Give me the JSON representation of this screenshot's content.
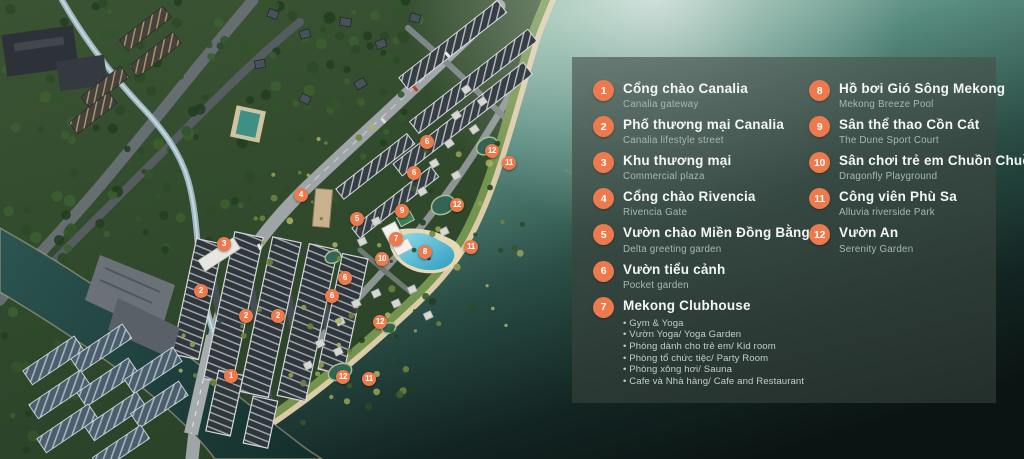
{
  "legend": {
    "column1": [
      {
        "num": "1",
        "title": "Cổng chào Canalia",
        "subtitle": "Canalia gateway"
      },
      {
        "num": "2",
        "title": "Phố thương mại Canalia",
        "subtitle": "Canalia lifestyle street"
      },
      {
        "num": "3",
        "title": "Khu thương mại",
        "subtitle": "Commercial plaza"
      },
      {
        "num": "4",
        "title": "Cổng chào Rivencia",
        "subtitle": "Rivencia Gate"
      },
      {
        "num": "5",
        "title": "Vườn chào Miền Đồng Bằng",
        "subtitle": "Delta greeting garden"
      },
      {
        "num": "6",
        "title": "Vườn tiểu cảnh",
        "subtitle": "Pocket garden"
      },
      {
        "num": "7",
        "title": "Mekong Clubhouse",
        "subtitle": "",
        "bullets": [
          "Gym & Yoga",
          "Vườn Yoga/ Yoga Garden",
          "Phòng dành cho trẻ em/ Kid room",
          "Phòng tổ chức tiệc/ Party Room",
          "Phòng xông hơi/ Sauna",
          "Cafe và Nhà hàng/ Cafe and Restaurant"
        ]
      }
    ],
    "column2": [
      {
        "num": "8",
        "title": "Hồ bơi Gió Sông Mekong",
        "subtitle": "Mekong Breeze Pool"
      },
      {
        "num": "9",
        "title": "Sân thể thao Cồn Cát",
        "subtitle": "The Dune Sport Court"
      },
      {
        "num": "10",
        "title": "Sân chơi trẻ em Chuồn Chuồn",
        "subtitle": "Dragonfly Playground"
      },
      {
        "num": "11",
        "title": "Công viên Phù Sa",
        "subtitle": "Alluvia riverside Park"
      },
      {
        "num": "12",
        "title": "Vườn An",
        "subtitle": "Serenity Garden"
      }
    ]
  },
  "map": {
    "markers": [
      {
        "num": "1",
        "x": 231,
        "y": 376
      },
      {
        "num": "2",
        "x": 201,
        "y": 291
      },
      {
        "num": "2",
        "x": 246,
        "y": 316
      },
      {
        "num": "2",
        "x": 278,
        "y": 316
      },
      {
        "num": "3",
        "x": 224,
        "y": 244
      },
      {
        "num": "4",
        "x": 301,
        "y": 195
      },
      {
        "num": "5",
        "x": 357,
        "y": 219
      },
      {
        "num": "6",
        "x": 427,
        "y": 142
      },
      {
        "num": "6",
        "x": 414,
        "y": 173
      },
      {
        "num": "6",
        "x": 345,
        "y": 278
      },
      {
        "num": "6",
        "x": 332,
        "y": 296
      },
      {
        "num": "7",
        "x": 396,
        "y": 239
      },
      {
        "num": "8",
        "x": 425,
        "y": 252
      },
      {
        "num": "9",
        "x": 402,
        "y": 211
      },
      {
        "num": "10",
        "x": 382,
        "y": 259
      },
      {
        "num": "11",
        "x": 509,
        "y": 163
      },
      {
        "num": "11",
        "x": 471,
        "y": 247
      },
      {
        "num": "11",
        "x": 369,
        "y": 379
      },
      {
        "num": "12",
        "x": 492,
        "y": 151
      },
      {
        "num": "12",
        "x": 457,
        "y": 205
      },
      {
        "num": "12",
        "x": 380,
        "y": 322
      },
      {
        "num": "12",
        "x": 343,
        "y": 377
      }
    ]
  },
  "colors": {
    "accent_orange": "#ED7A4D",
    "pool_blue": "#5FC0DC",
    "water_light": "#8AB5A7",
    "water_dark": "#0C1514",
    "panel_bg": "#3A4845",
    "sand": "#DBCBA6"
  }
}
